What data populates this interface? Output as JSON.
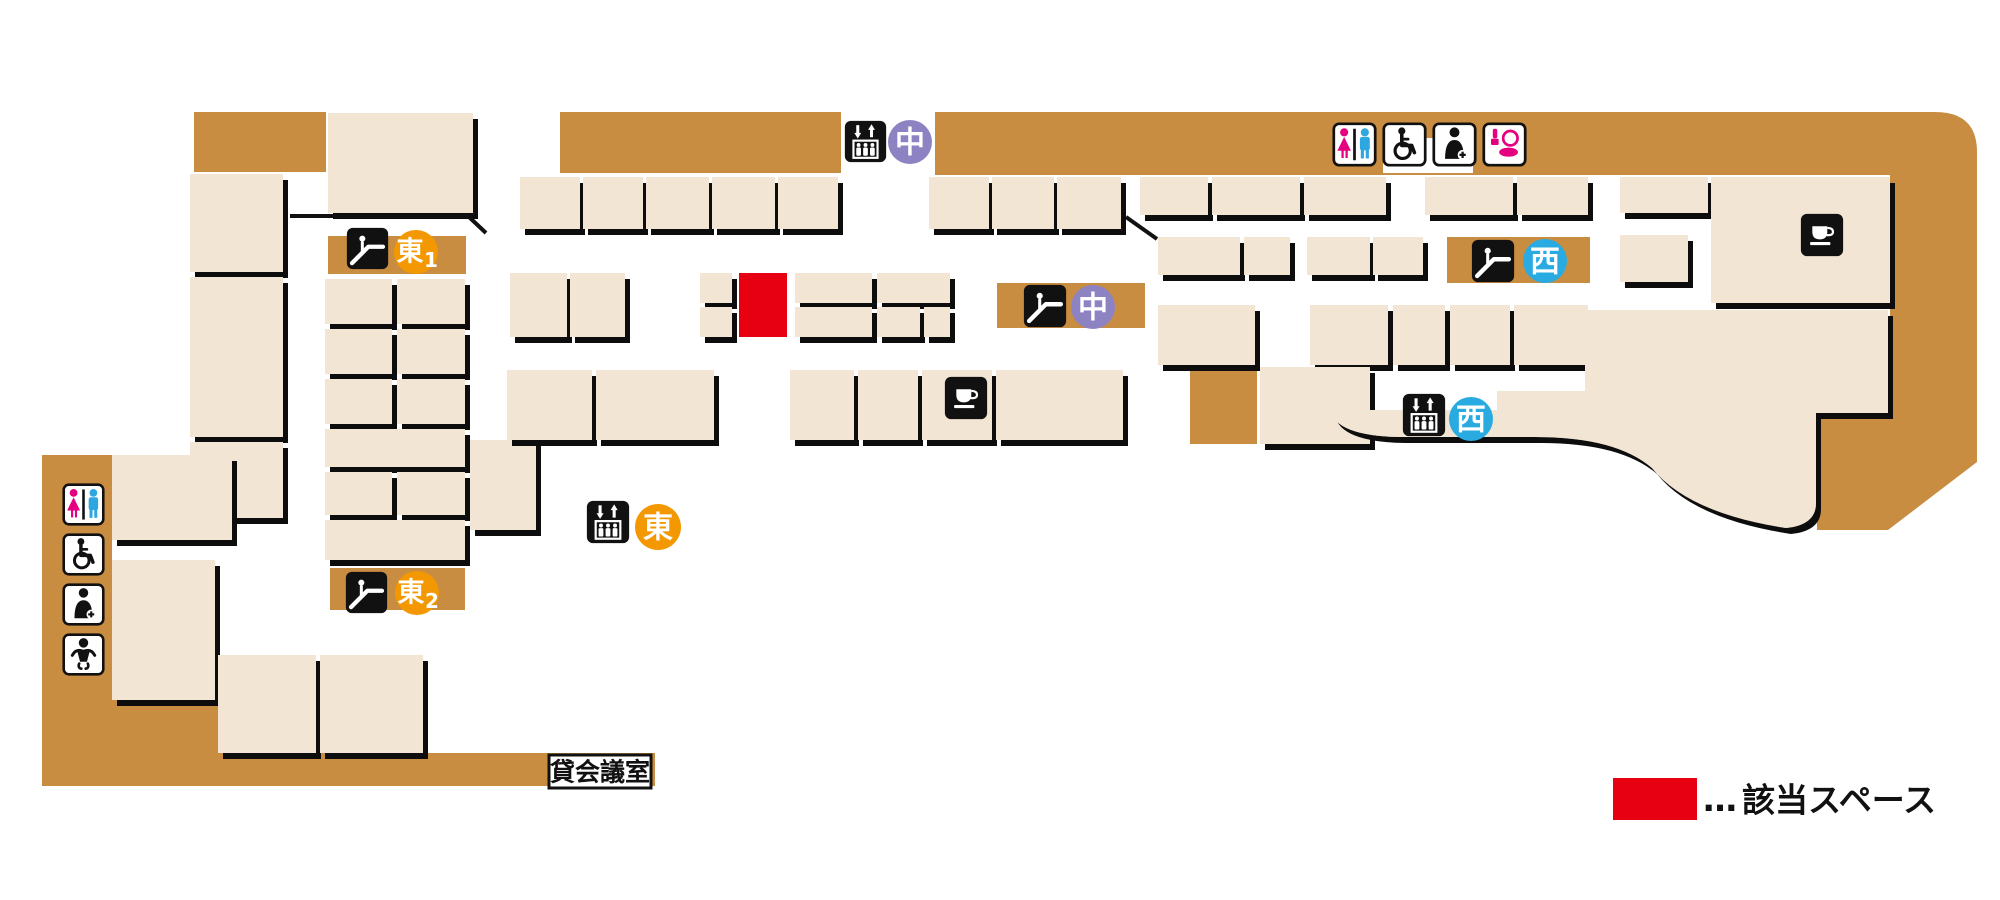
{
  "legend": {
    "dots": "…",
    "label": "該当スペース",
    "swatch_color": "#e60012"
  },
  "labels": {
    "rental_meeting_room": "貸会議室"
  },
  "markers": {
    "center_elevator": {
      "label": "中",
      "circle_color": "#8d83c3",
      "icon": "elevator"
    },
    "center_escalator": {
      "label": "中",
      "circle_color": "#8d83c3",
      "icon": "escalator"
    },
    "west_escalator": {
      "label": "西",
      "circle_color": "#29abe2",
      "icon": "escalator"
    },
    "west_elevator": {
      "label": "西",
      "circle_color": "#29abe2",
      "icon": "elevator"
    },
    "east_elevator": {
      "label": "東",
      "circle_color": "#f39800",
      "icon": "elevator"
    },
    "east1_escalator": {
      "label": "東",
      "number": "1",
      "circle_color": "#f39800",
      "icon": "escalator"
    },
    "east2_escalator": {
      "label": "東",
      "number": "2",
      "circle_color": "#f39800",
      "icon": "escalator"
    }
  },
  "facility_icons": {
    "top_right": [
      "toilet",
      "wheelchair-accessible",
      "first-aid-room",
      "powder-room"
    ],
    "bottom_left": [
      "toilet",
      "wheelchair-accessible",
      "first-aid-room",
      "baby-care-room"
    ],
    "cafes": [
      "cafe-center",
      "cafe-west"
    ]
  },
  "colors": {
    "floor_brown": "#c98d42",
    "room_beige": "#f2e5d4",
    "highlight_red": "#e60012",
    "center_purple": "#8d83c3",
    "west_blue": "#29abe2",
    "east_orange": "#f39800",
    "woman_pink": "#e4007f",
    "man_blue": "#2ea7e0",
    "outline_black": "#111111"
  }
}
